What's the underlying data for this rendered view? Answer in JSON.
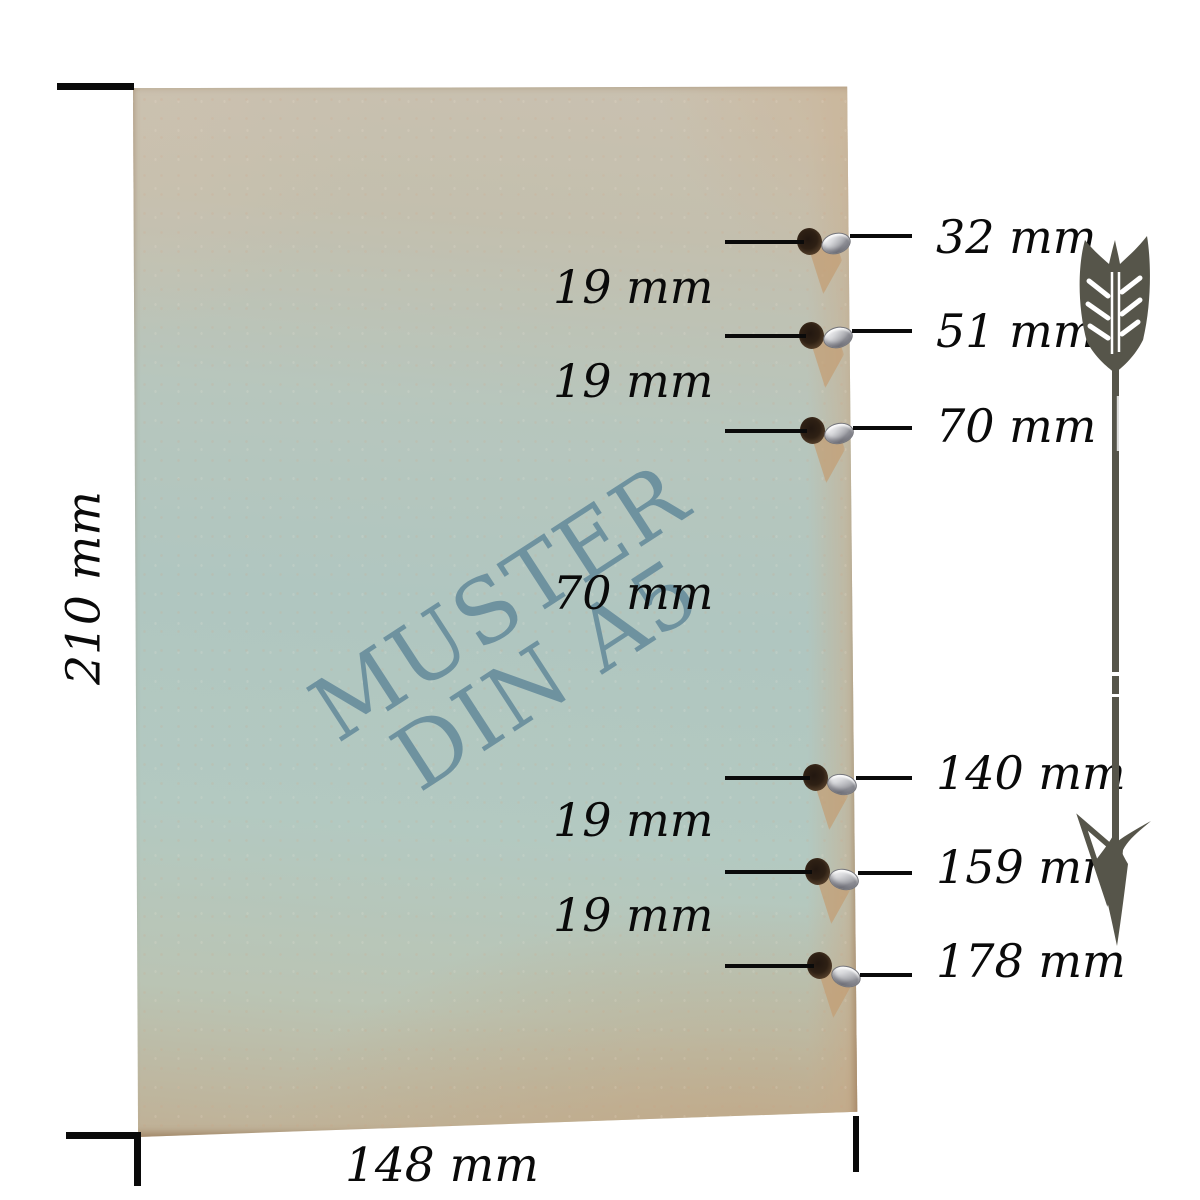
{
  "cover": {
    "watermark": {
      "line1": "MUSTER",
      "line2": "DIN A5",
      "color": "#688da0"
    },
    "base_color": "#b0c6c0",
    "edge_tint": "#c2a98c",
    "eyelet_color": "#c9cacd"
  },
  "dimensions": {
    "height_label": "210 mm",
    "width_label": "148 mm"
  },
  "holes": [
    {
      "label": "32 mm"
    },
    {
      "label": "51 mm"
    },
    {
      "label": "70 mm"
    },
    {
      "label": "140 mm"
    },
    {
      "label": "159 mm"
    },
    {
      "label": "178 mm"
    }
  ],
  "gaps": [
    {
      "label": "19 mm"
    },
    {
      "label": "19 mm"
    },
    {
      "label": "70 mm"
    },
    {
      "label": "19 mm"
    },
    {
      "label": "19 mm"
    }
  ],
  "arrow": {
    "icon": "feather-arrow-down",
    "color": "#56554a"
  },
  "ink_color": "#0a0a0a"
}
